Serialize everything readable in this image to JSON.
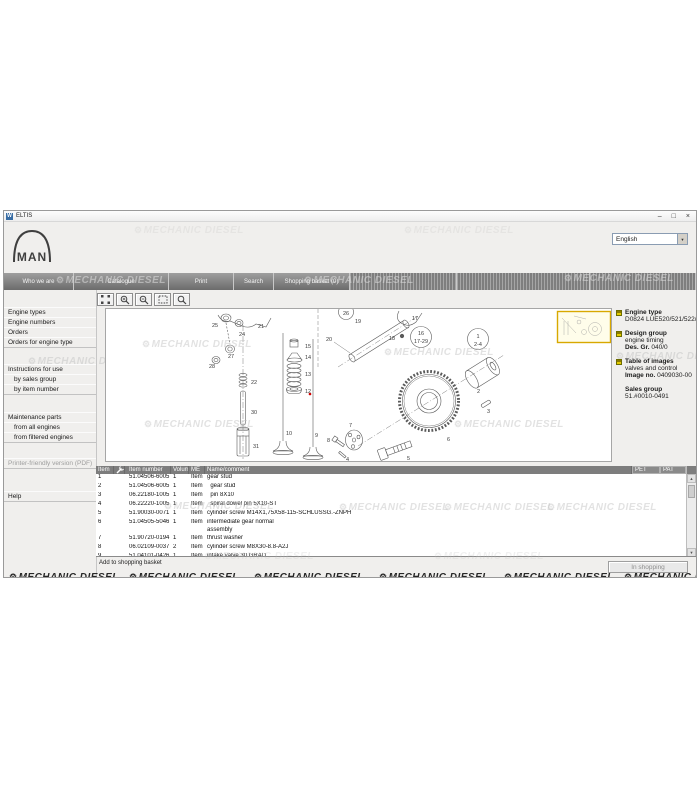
{
  "window": {
    "title": "ELTIS",
    "icon_letter": "W",
    "controls": {
      "minimize": "–",
      "maximize": "□",
      "close": "×"
    }
  },
  "header": {
    "logo_text": "MAN",
    "language": "English",
    "dropdown_arrow": "▼"
  },
  "nav": {
    "tabs": [
      {
        "label": "Who we are"
      },
      {
        "label": "Catalogue"
      },
      {
        "label": "Print"
      },
      {
        "label": "Search"
      },
      {
        "label": "Shopping basket (0)"
      }
    ]
  },
  "sidebar": {
    "items": [
      {
        "label": "Engine types"
      },
      {
        "label": "Engine numbers"
      },
      {
        "label": "Orders"
      },
      {
        "label": "Orders for engine type"
      },
      {
        "label": "Instructions for use"
      },
      {
        "label": "by sales group"
      },
      {
        "label": "by item number"
      },
      {
        "label": "Maintenance parts"
      },
      {
        "label": "from all engines"
      },
      {
        "label": "from filtered engines"
      },
      {
        "label": "Printer-friendly version (PDF)"
      },
      {
        "label": "Help"
      }
    ]
  },
  "toolbar": {
    "buttons": [
      "fit-view",
      "zoom-in",
      "zoom-out",
      "zoom-area",
      "magnifier"
    ]
  },
  "diagram": {
    "callouts": [
      {
        "t": "25",
        "x": 106,
        "y": 18
      },
      {
        "t": "24",
        "x": 133,
        "y": 27
      },
      {
        "t": "21",
        "x": 152,
        "y": 19
      },
      {
        "t": "27",
        "x": 122,
        "y": 49
      },
      {
        "t": "28",
        "x": 103,
        "y": 59
      },
      {
        "t": "22",
        "x": 145,
        "y": 75
      },
      {
        "t": "30",
        "x": 145,
        "y": 105
      },
      {
        "t": "31",
        "x": 147,
        "y": 139
      },
      {
        "t": "15",
        "x": 199,
        "y": 39
      },
      {
        "t": "14",
        "x": 199,
        "y": 50
      },
      {
        "t": "13",
        "x": 199,
        "y": 67
      },
      {
        "t": "12",
        "x": 199,
        "y": 84
      },
      {
        "t": "10",
        "x": 180,
        "y": 126
      },
      {
        "t": "9",
        "x": 209,
        "y": 128
      },
      {
        "t": "19",
        "x": 249,
        "y": 14
      },
      {
        "t": "20",
        "x": 220,
        "y": 32
      },
      {
        "t": "18",
        "x": 283,
        "y": 31
      },
      {
        "t": "17",
        "x": 306,
        "y": 11
      },
      {
        "t": "26",
        "x": 240,
        "y": 6,
        "a": "m"
      },
      {
        "t": "16",
        "x": 315,
        "y": 26,
        "a": "m"
      },
      {
        "t": "17-29",
        "x": 315,
        "y": 34,
        "a": "m"
      },
      {
        "t": "1",
        "x": 372,
        "y": 29,
        "a": "m"
      },
      {
        "t": "2-4",
        "x": 372,
        "y": 37,
        "a": "m"
      },
      {
        "t": "2",
        "x": 371,
        "y": 84
      },
      {
        "t": "3",
        "x": 381,
        "y": 104
      },
      {
        "t": "6",
        "x": 341,
        "y": 132
      },
      {
        "t": "5",
        "x": 301,
        "y": 151
      },
      {
        "t": "7",
        "x": 243,
        "y": 118
      },
      {
        "t": "8",
        "x": 221,
        "y": 133
      },
      {
        "t": "4",
        "x": 240,
        "y": 152
      }
    ]
  },
  "info_panel": {
    "engine_type": {
      "label": "Engine type",
      "value": "D0824 LUE520/521/522/52"
    },
    "design_group": {
      "label": "Design group",
      "line1": "engine timing",
      "line2_label": "Des. Gr.",
      "line2_value": "040/0"
    },
    "table_of_images": {
      "label": "Table of images",
      "line1": "valves and control",
      "line2_label": "Image no.",
      "line2_value": "0409030-00"
    },
    "sales_group": {
      "label": "Sales group",
      "value": "51.#0010-0491"
    }
  },
  "table": {
    "headers": {
      "item": "Item",
      "item_number": "Item number",
      "volume": "Volume",
      "me": "ME",
      "name": "Name/comment",
      "pet": "PET",
      "pat": "PAT"
    },
    "rows": [
      {
        "item": "1",
        "number": "51.04506-6005",
        "vol": "1",
        "me": "Item",
        "name": "gear stud"
      },
      {
        "item": "2",
        "number": "51.04506-6005",
        "vol": "1",
        "me": "Item",
        "name": "  gear stud"
      },
      {
        "item": "3",
        "number": "06.22180-1005",
        "vol": "1",
        "me": "Item",
        "name": "  pin 8X10"
      },
      {
        "item": "4",
        "number": "06.22220-1005",
        "vol": "1",
        "me": "Item",
        "name": "  spiral dowel pin 5X10-ST"
      },
      {
        "item": "5",
        "number": "51.90030-0071",
        "vol": "1",
        "me": "Item",
        "name": "cylinder screw M14X1,75X58-115-SCHLUSSG.-ZNPH"
      },
      {
        "item": "6",
        "number": "51.04505-5046",
        "vol": "1",
        "me": "Item",
        "name": "intermediate gear normal\nassembly"
      },
      {
        "item": "7",
        "number": "51.90720-0194",
        "vol": "1",
        "me": "Item",
        "name": "thrust washer"
      },
      {
        "item": "8",
        "number": "06.02109-0037",
        "vol": "2",
        "me": "Item",
        "name": "cylinder screw M8X30-8.8-A2J"
      },
      {
        "item": "9",
        "number": "51.04101-0426",
        "vol": "1",
        "me": "Item",
        "name": "intake valve 30 GRAD"
      }
    ],
    "scroll": {
      "up": "▲",
      "down": "▼"
    }
  },
  "footer": {
    "add_to_basket": "Add to shopping basket",
    "in_shopping": "In shopping"
  },
  "watermark": {
    "icon": "⚙",
    "text": "MECHANIC DIESEL"
  },
  "colors": {
    "accent_yellow": "#e3cb00",
    "thumbnail_border": "#d8a800",
    "header_gray": "#7d7d7d",
    "red_marker": "#d00000"
  }
}
